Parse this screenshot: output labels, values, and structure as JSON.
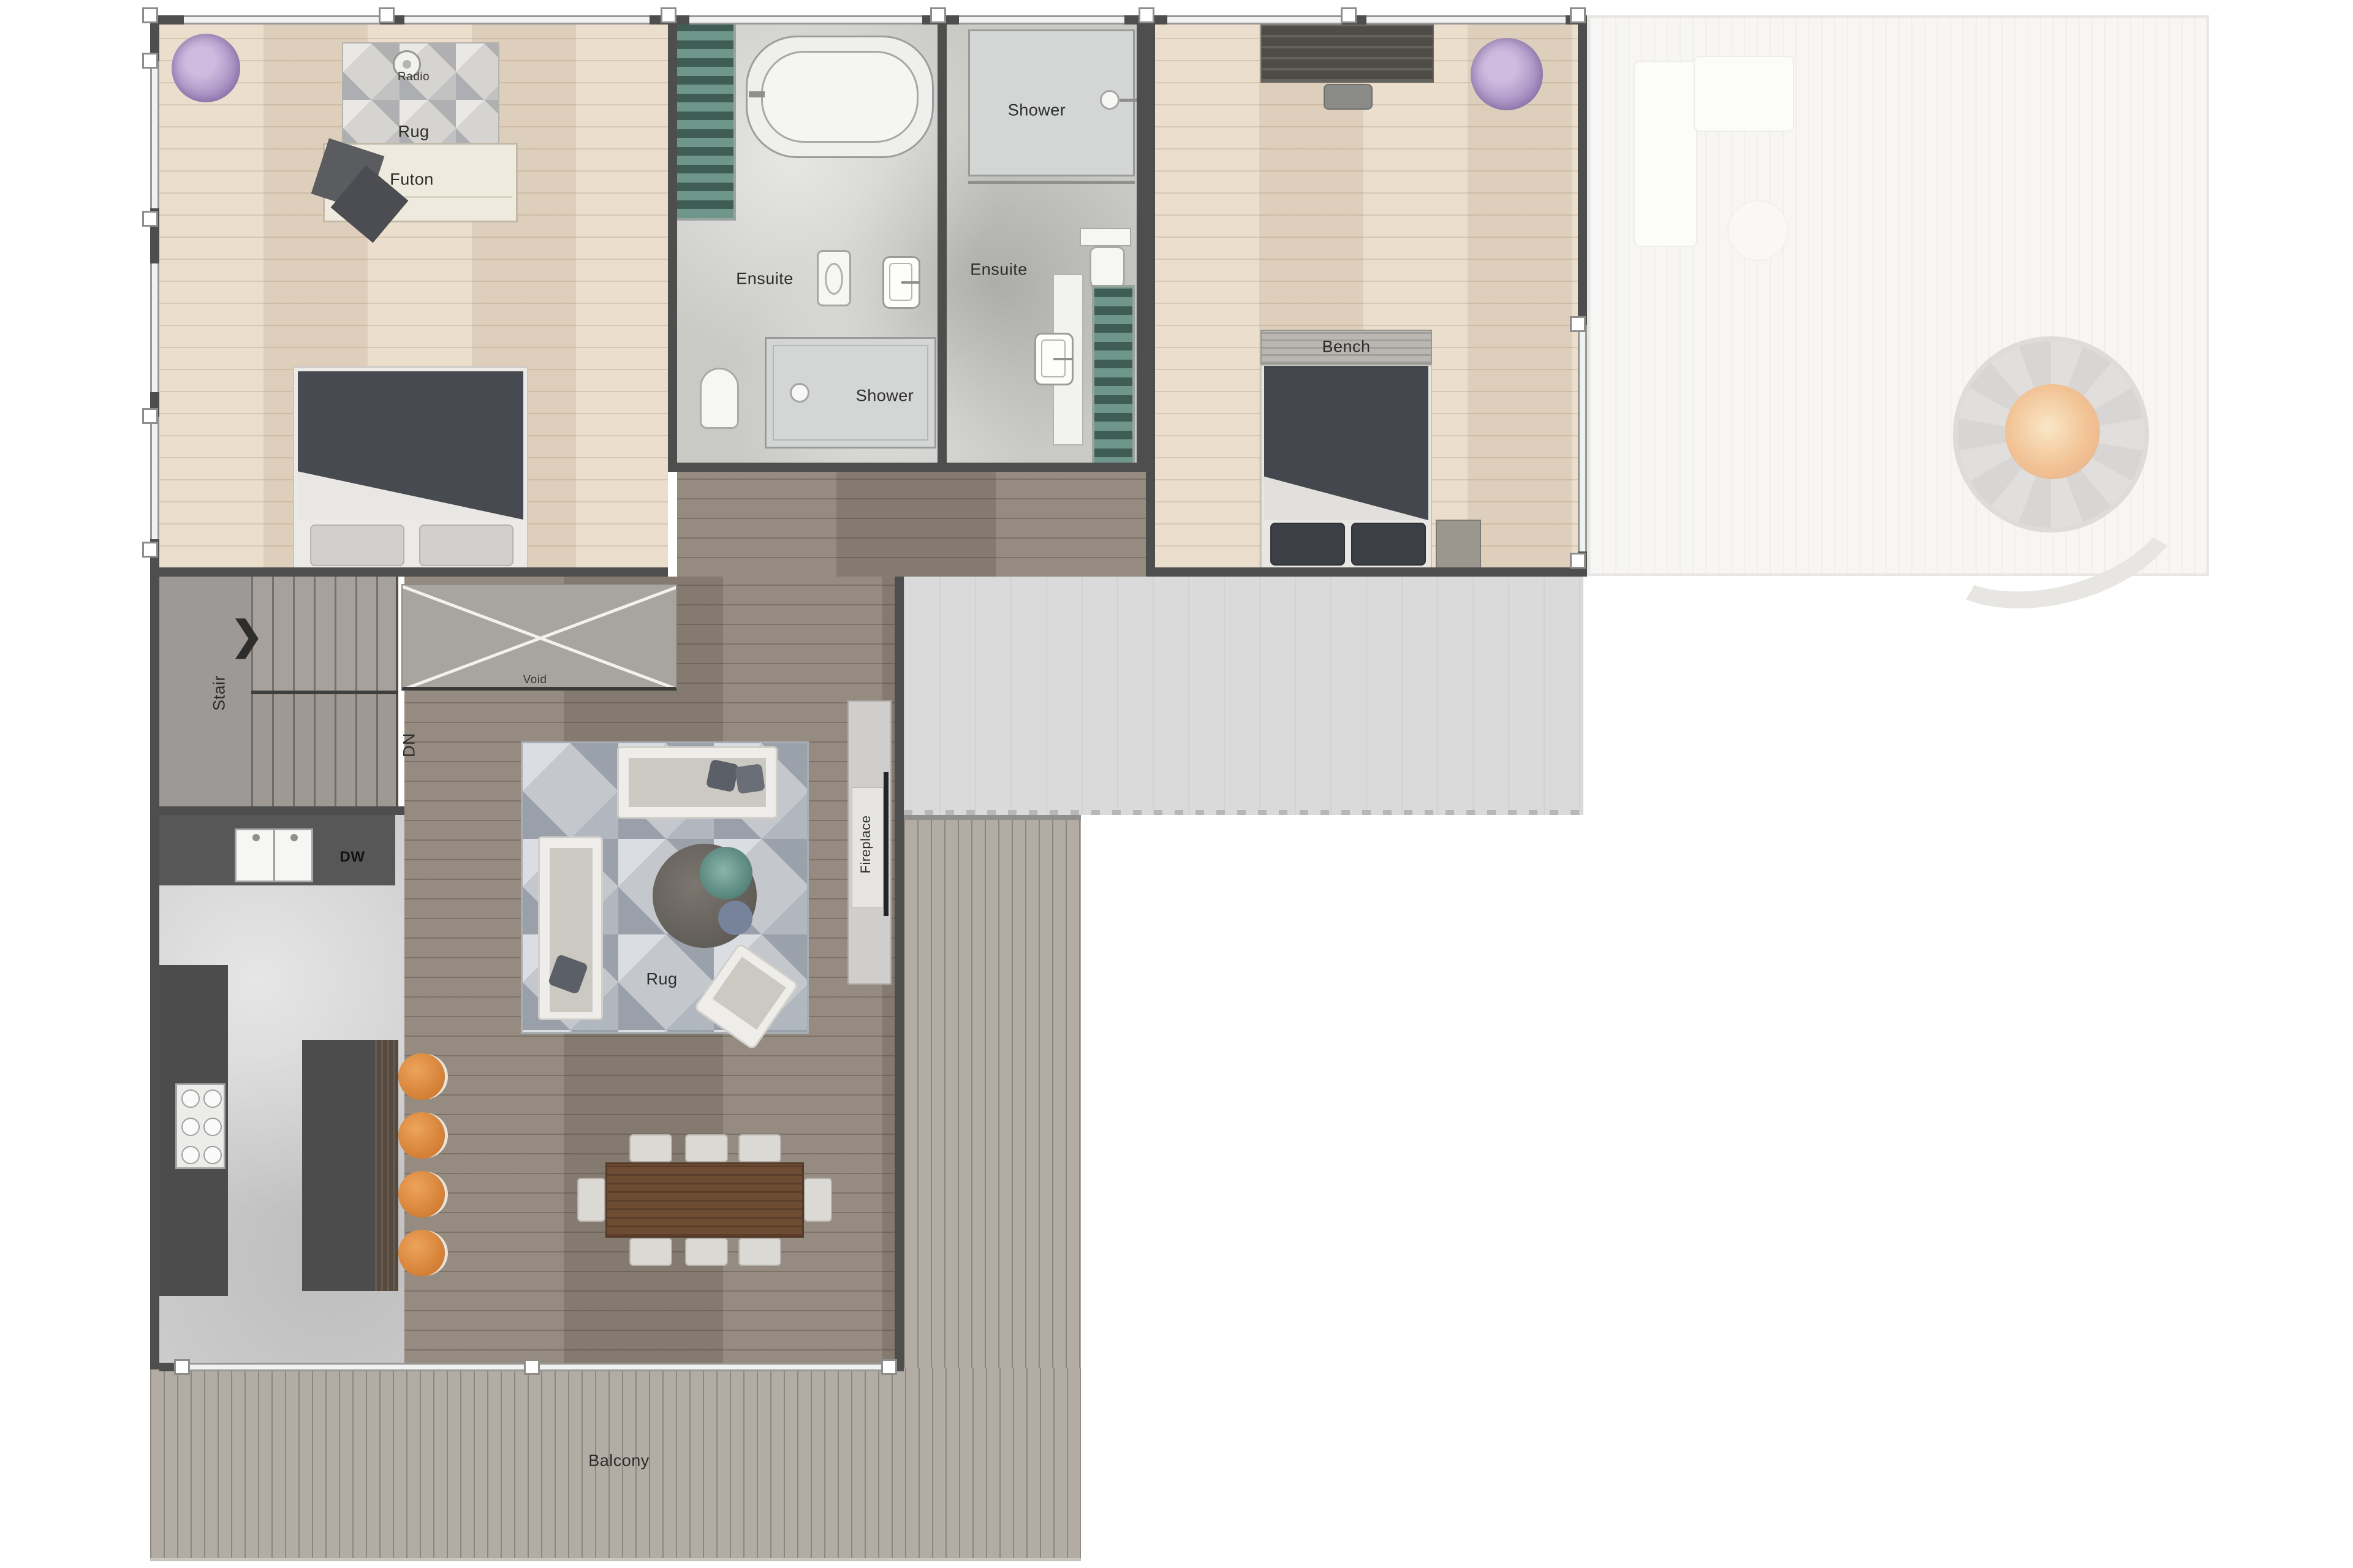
{
  "labels": {
    "bedroom1_rug": "Rug",
    "radio": "Radio",
    "futon": "Futon",
    "ensuite_left": "Ensuite",
    "shower_left": "Shower",
    "shower_right": "Shower",
    "ensuite_right": "Ensuite",
    "bench": "Bench",
    "stair": "Stair",
    "down": "DN",
    "void": "Void",
    "dishwasher": "DW",
    "fireplace": "Fireplace",
    "living_rug": "Rug",
    "balcony": "Balcony"
  },
  "icons": {
    "stair_direction_arrow": "❯"
  },
  "colors": {
    "wall": "#4e4e4e",
    "bedroom_floor": "#e7d8c4",
    "living_floor": "#8d8276",
    "bathroom_floor": "#c9c9c6",
    "kitchen_floor": "#cdcdcd",
    "terrace": "#dadada",
    "balcony_deck": "#b2aca4",
    "outdoor_deck": "#f1f0ee",
    "stool_orange": "#dd8a42",
    "fire_orange": "#e8923f",
    "shelf_green": "#55776c",
    "plant_purple": "#a78fc2",
    "duvet_grey": "#474a50",
    "dining_table_walnut": "#6e4c34"
  }
}
